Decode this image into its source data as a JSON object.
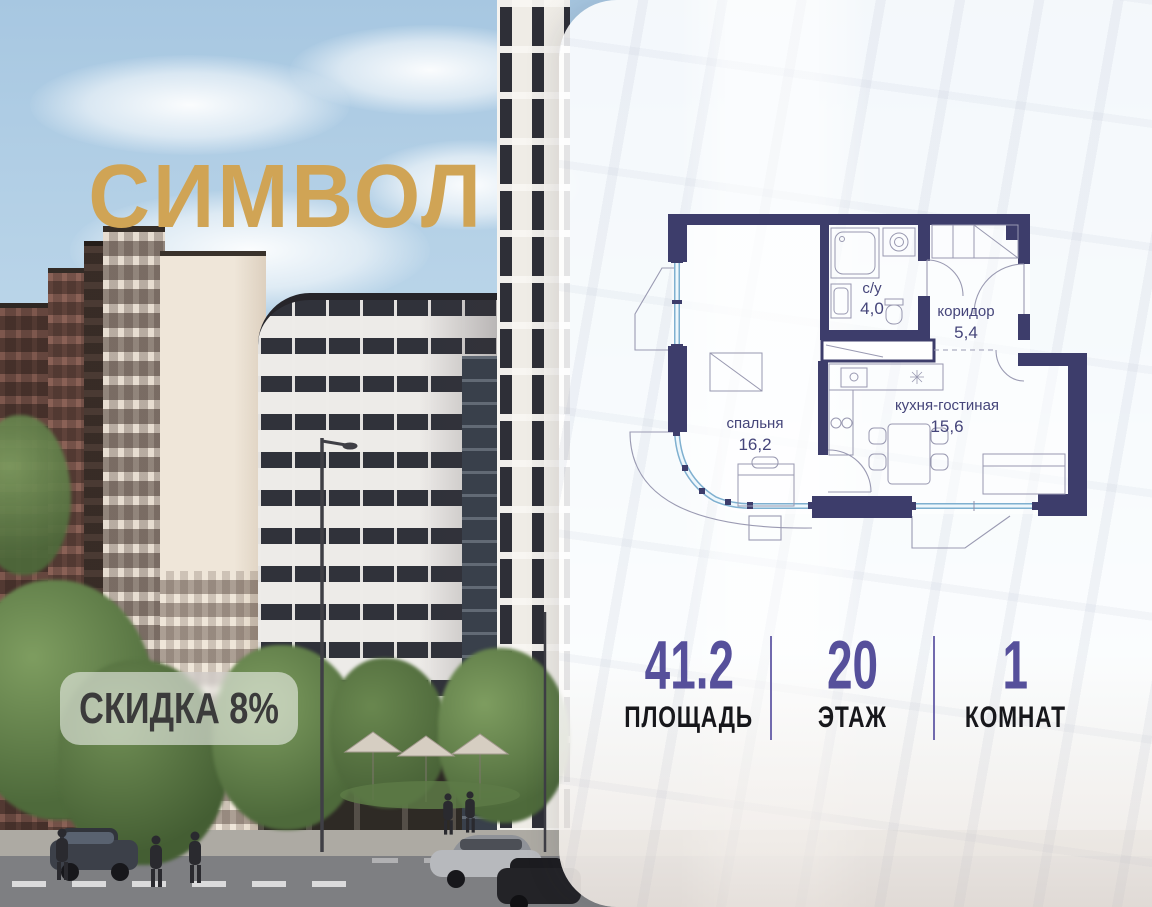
{
  "brand": {
    "name": "СИМВОЛ",
    "logo_color": "#d0a455"
  },
  "badge": {
    "text": "СКИДКА 8%"
  },
  "floor_plan": {
    "rooms": [
      {
        "name": "с/у",
        "area": "4,0"
      },
      {
        "name": "коридор",
        "area": "5,4"
      },
      {
        "name": "спальня",
        "area": "16,2"
      },
      {
        "name": "кухня-гостиная",
        "area": "15,6"
      }
    ],
    "wall_color": "#3d3d6b",
    "window_color": "#7fb0d0"
  },
  "stats": [
    {
      "value": "41.2",
      "label": "ПЛОЩАДЬ"
    },
    {
      "value": "20",
      "label": "ЭТАЖ"
    },
    {
      "value": "1",
      "label": "КОМНАТ"
    }
  ],
  "colors": {
    "accent_purple": "#56509b",
    "brand_gold": "#d0a455",
    "badge_text": "#3b3b3b"
  }
}
